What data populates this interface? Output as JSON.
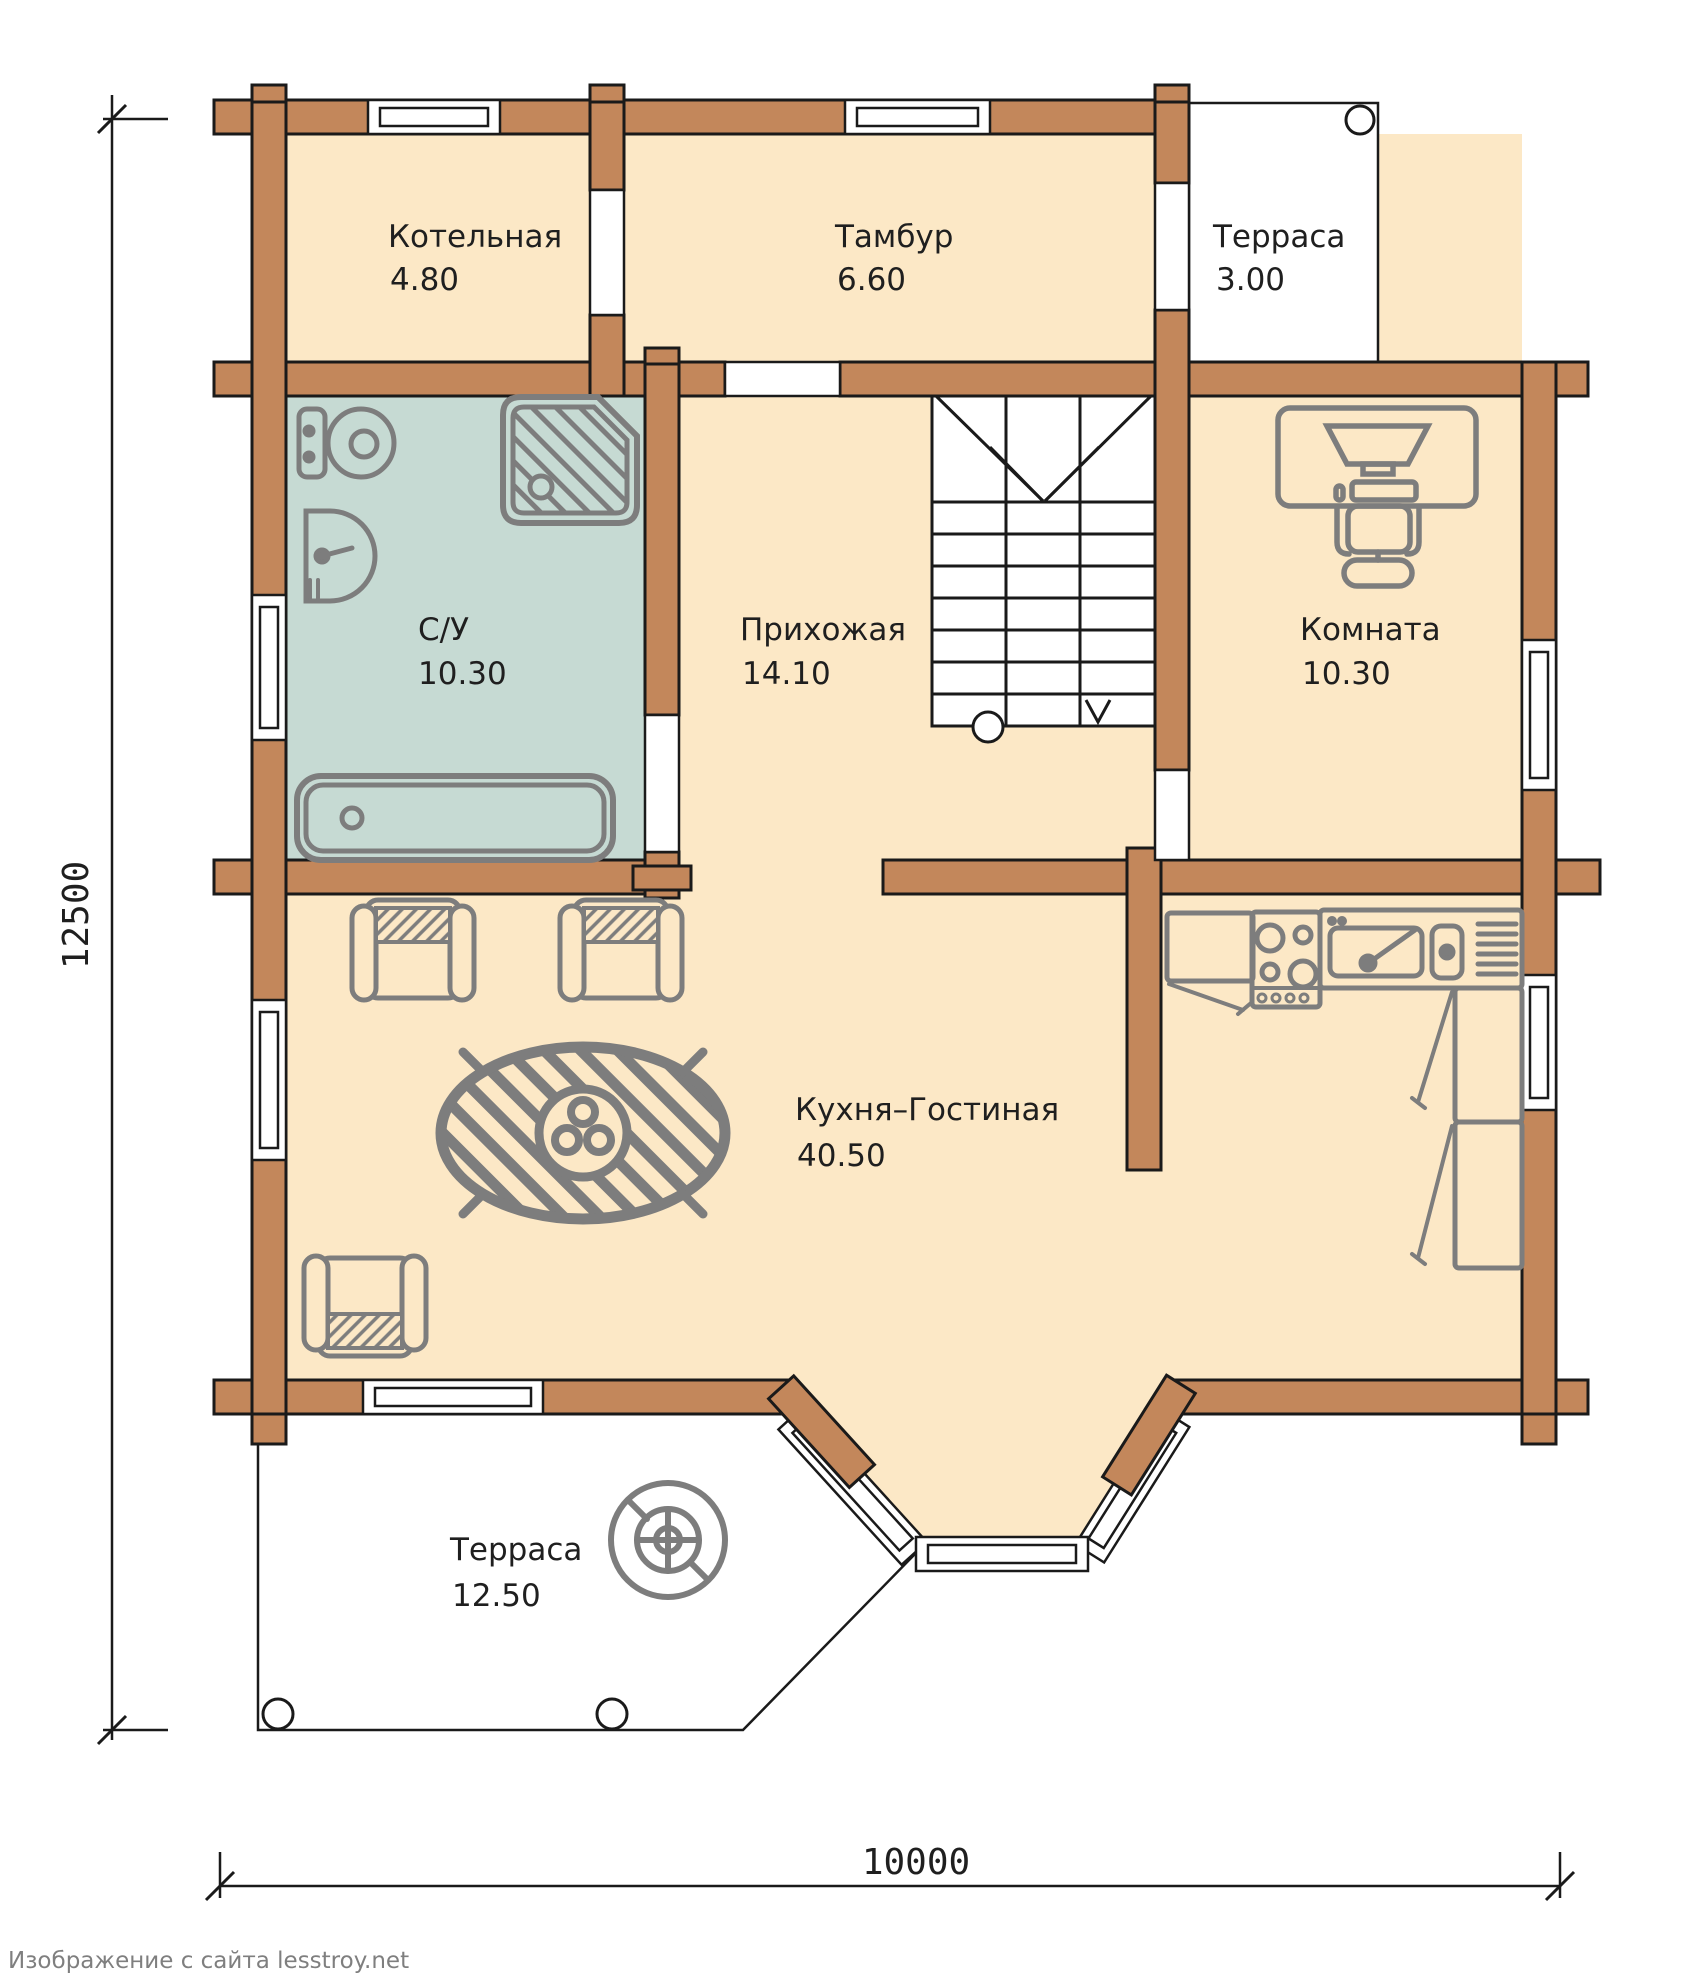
{
  "page": {
    "watermark": "Изображение с сайта lesstroy.net"
  },
  "plan": {
    "type": "floor-plan",
    "dimensions": {
      "vertical": "12500",
      "horizontal": "10000"
    },
    "rooms": [
      {
        "id": "boiler",
        "name": "Котельная",
        "area": "4.80"
      },
      {
        "id": "vestibule",
        "name": "Тамбур",
        "area": "6.60"
      },
      {
        "id": "terrace-top",
        "name": "Терраса",
        "area": "3.00"
      },
      {
        "id": "bathroom",
        "name": "С/У",
        "area": "10.30"
      },
      {
        "id": "hallway",
        "name": "Прихожая",
        "area": "14.10"
      },
      {
        "id": "room",
        "name": "Комната",
        "area": "10.30"
      },
      {
        "id": "kitchen-living",
        "name": "Кухня–Гостиная",
        "area": "40.50"
      },
      {
        "id": "terrace-bottom",
        "name": "Терраса",
        "area": "12.50"
      }
    ],
    "colors": {
      "wall": "#c3875b",
      "outline": "#1a1a1a",
      "floor": "#fce8c6",
      "bathroom_floor": "#c6dad3",
      "furniture": "#7d7d7d",
      "terrace": "#ffffff"
    },
    "icons": {
      "toilet": "toilet-icon",
      "washbasin": "washbasin-icon",
      "shower": "shower-icon",
      "bathtub": "bathtub-icon",
      "staircase": "stairs-icon",
      "desk": "desk-icon",
      "armchair": "armchair-icon",
      "dining_table": "dining-table-icon",
      "kitchen_counter": "kitchen-counter-icon",
      "stove": "stove-icon",
      "kitchen_sink": "kitchen-sink-icon",
      "cabinets": "kitchen-cabinet-icon",
      "round_table": "round-table-icon",
      "column": "column-icon"
    }
  }
}
